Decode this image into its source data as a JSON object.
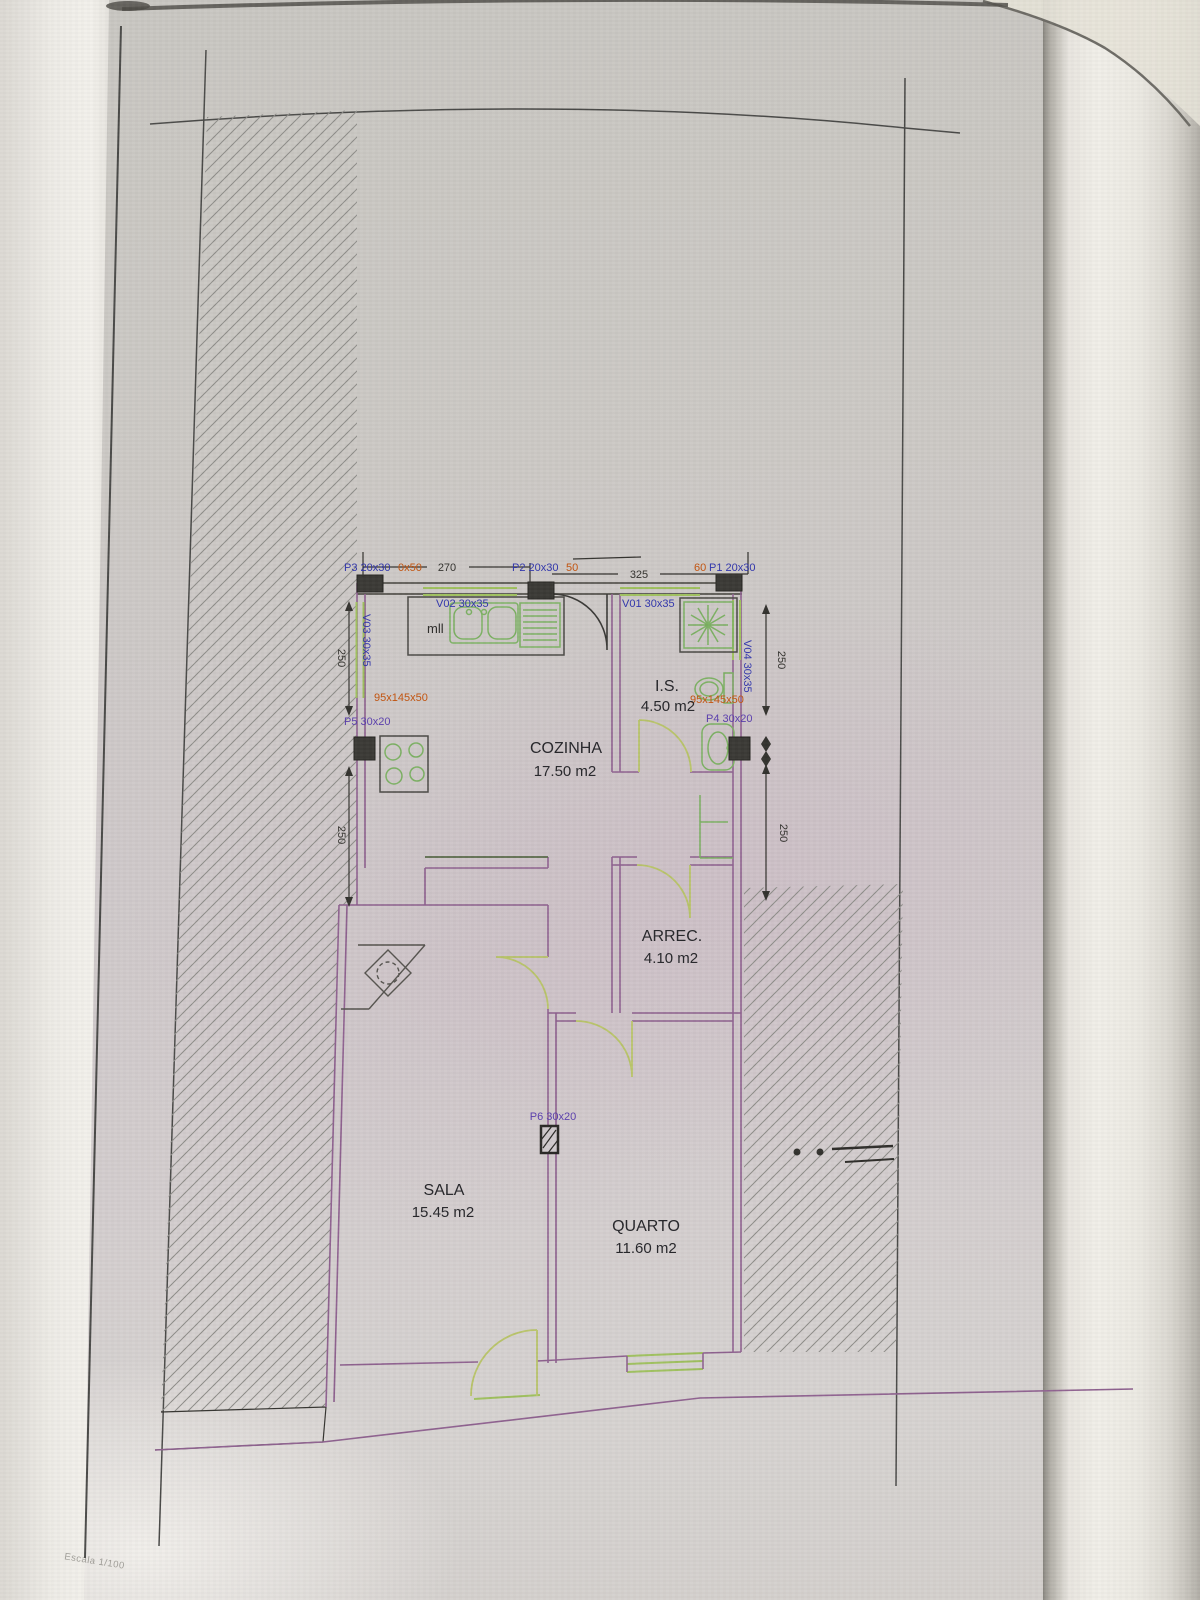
{
  "page": {
    "scale_note": "Escala 1/100"
  },
  "plan": {
    "rooms": [
      {
        "id": "cozinha",
        "name": "COZINHA",
        "area": "17.50 m2"
      },
      {
        "id": "is",
        "name": "I.S.",
        "area": "4.50 m2"
      },
      {
        "id": "arrec",
        "name": "ARREC.",
        "area": "4.10 m2"
      },
      {
        "id": "sala",
        "name": "SALA",
        "area": "15.45 m2"
      },
      {
        "id": "quarto",
        "name": "QUARTO",
        "area": "11.60 m2"
      }
    ],
    "labels": {
      "p1": "P1 20x30",
      "p1_note": "60",
      "p2": "P2 20x30",
      "p2_note": "50",
      "p3": "P3 20x30",
      "p3_note": "0x50",
      "p4": "P4 30x20",
      "p5": "P5 30x20",
      "p6": "P6 30x20",
      "v01": "V01 30x35",
      "v02": "V02 30x35",
      "v03": "V03 30x35",
      "v04": "V04 30x35",
      "counter_left": "95x145x50",
      "counter_right": "95x145x50",
      "kitchen_note": "mll"
    },
    "dimensions": {
      "top_left": "270",
      "top_right": "325",
      "left_upper": "250",
      "left_lower": "250",
      "right_upper": "250",
      "right_lower": "250"
    }
  },
  "colors": {
    "label-blue": "#3136ad",
    "label-purple": "#5b3fae",
    "label-orange": "#c4540e",
    "wall-purple": "#8f6290",
    "wall-dark": "#55534e",
    "fixture-green": "#7cb163",
    "door-green": "#b9c46a",
    "window-green": "#9fc05e",
    "pillar-dark": "#3b3a36",
    "dim-dark": "#34332f",
    "hatch-gray": "#8e8d89"
  }
}
